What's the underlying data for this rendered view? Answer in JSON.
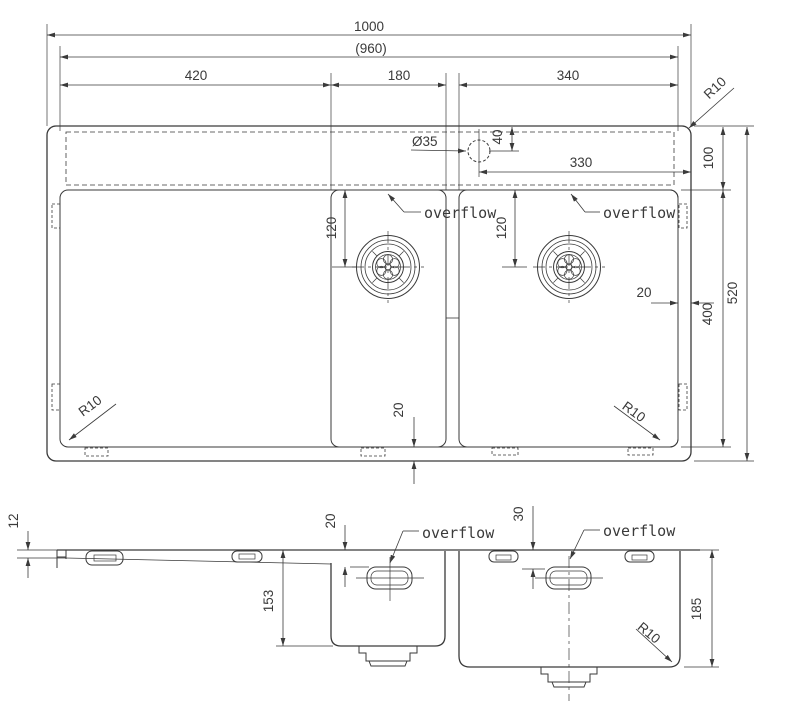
{
  "drawing": {
    "background": "#ffffff",
    "line_color": "#3a3a3a",
    "top_view": {
      "overall_width": "1000",
      "inner_width": "(960)",
      "drainboard_width": "420",
      "small_bowl_width": "180",
      "large_bowl_width": "340",
      "corner_radius_top_right": "R10",
      "corner_radius_bottom_left": "R10",
      "corner_radius_bottom_right": "R10",
      "faucet_hole_diameter": "Ø35",
      "faucet_hole_offset": "40",
      "faucet_hole_from_right": "330",
      "ledge_depth": "100",
      "overflow_left": "overflow",
      "overflow_right": "overflow",
      "drain_offset_left": "120",
      "drain_offset_right": "120",
      "rim_right": "20",
      "rim_bottom": "20",
      "bowl_opening_depth": "400",
      "overall_depth": "520"
    },
    "side_view": {
      "rim_thickness": "12",
      "overflow_top_offset_small": "20",
      "overflow_top_offset_large": "30",
      "overflow_small": "overflow",
      "overflow_large": "overflow",
      "small_bowl_depth": "153",
      "large_bowl_depth": "185",
      "bottom_corner_radius": "R10"
    }
  }
}
